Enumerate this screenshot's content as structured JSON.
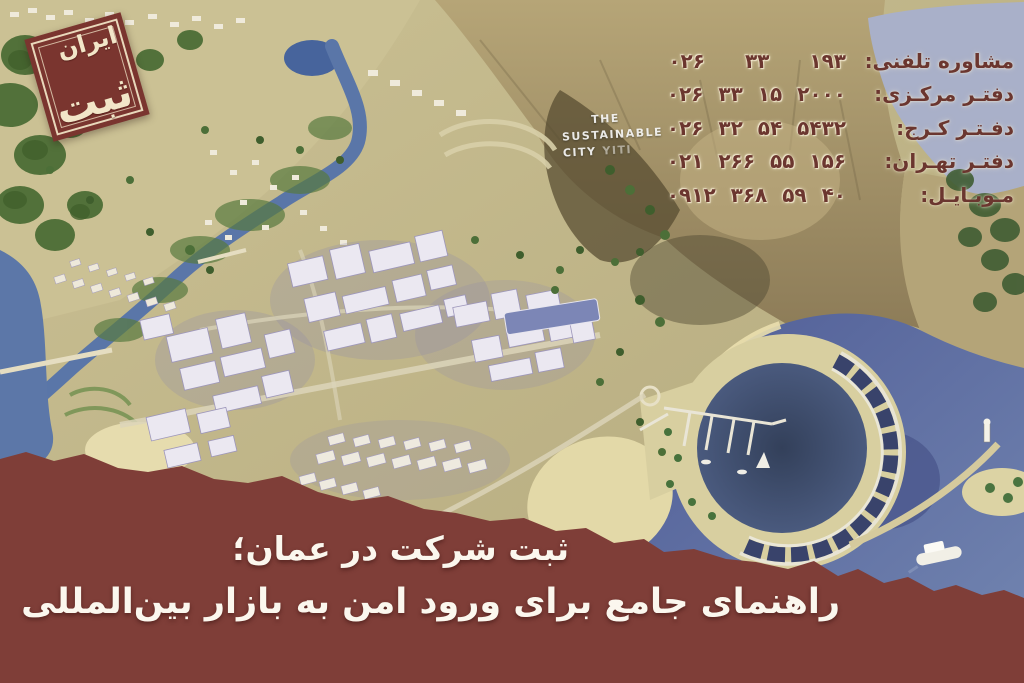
{
  "colors": {
    "brand_maroon": "#7f3e38",
    "logo_maroon": "#7a352f",
    "contact_text_maroon": "#6b362f",
    "banner_text_cream": "#fbf7ee"
  },
  "logo": {
    "top_word": "ایران",
    "bottom_word": "ثبت"
  },
  "contact": {
    "rows": [
      {
        "label": "مشاوره تلفنی:",
        "number": "۰۲۶  ۳۳  ۱۹۳"
      },
      {
        "label": "دفتـر مرکـزی:",
        "number": "۰۲۶ ۳۳ ۱۵ ۲۰۰۰"
      },
      {
        "label": "دفـتـر کـرج:",
        "number": "۰۲۶ ۳۲ ۵۴ ۵۴۳۲"
      },
      {
        "label": "دفتـر تهـران:",
        "number": "۰۲۱ ۲۶۶ ۵۵ ۱۵۶"
      },
      {
        "label": "مـوبـایـل:",
        "number": "۰۹۱۲ ۳۶۸ ۵۹ ۴۰"
      }
    ]
  },
  "hillside_sign": {
    "line1": "THE",
    "line2": "SUSTAINABLE",
    "line3": "CITY",
    "line3b": "YITI"
  },
  "banner": {
    "title": "ثبت شرکت در عمان؛",
    "subtitle": "راهنمای جامع برای ورود امن به بازار بین‌المللی"
  }
}
